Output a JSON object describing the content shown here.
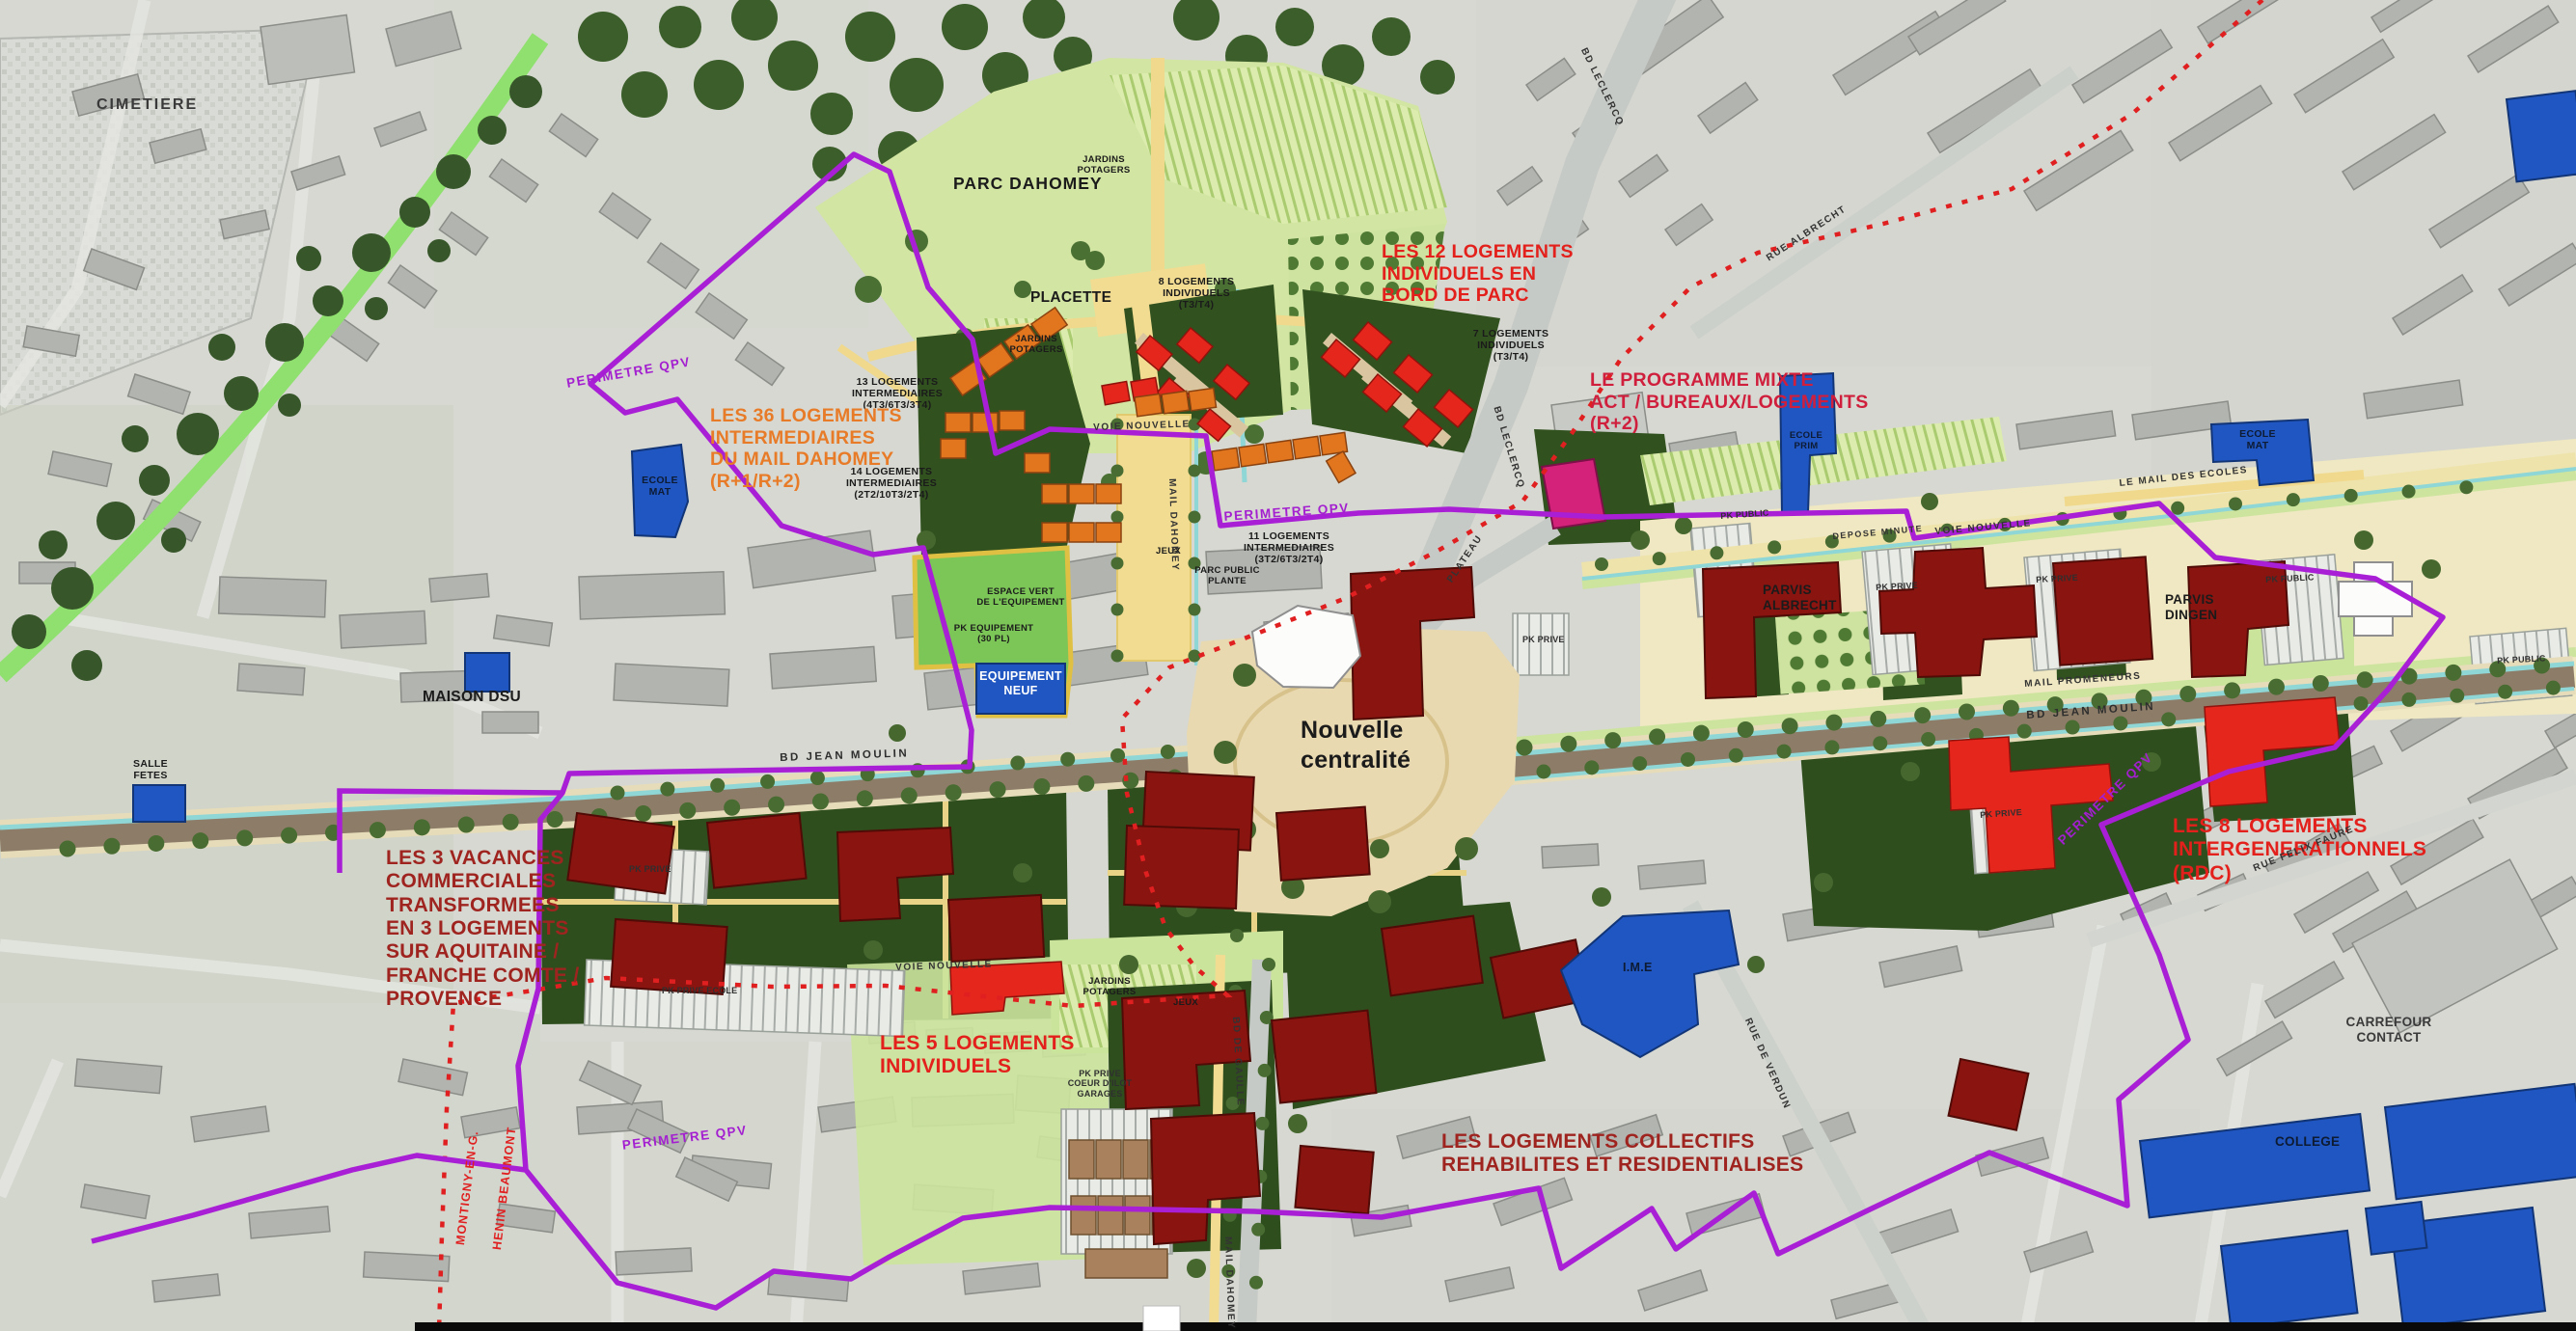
{
  "annotations": {
    "les12": "LES 12 LOGEMENTS\nINDIVIDUELS EN\nBORD DE PARC",
    "mixte": "LE PROGRAMME MIXTE\nACT / BUREAUX/LOGEMENTS\n(R+2)",
    "les36": "LES 36 LOGEMENTS\nINTERMEDIAIRES\nDU MAIL DAHOMEY\n(R+1/R+2)",
    "vacances": "LES 3 VACANCES\nCOMMERCIALES\nTRANSFORMEES\nEN 3 LOGEMENTS\nSUR AQUITAINE /\nFRANCHE COMTE /\nPROVENCE",
    "les5": "LES 5 LOGEMENTS\nINDIVIDUELS",
    "collectifs": "LES LOGEMENTS COLLECTIFS\nREHABILITES ET RESIDENTIALISES",
    "les8": "LES 8 LOGEMENTS\nINTERGENERATIONNELS\n(RDC)"
  },
  "places": {
    "parc": "PARC DAHOMEY",
    "placette": "PLACETTE",
    "centralite": "Nouvelle\ncentralité",
    "maison_dsu": "MAISON DSU",
    "salle_fetes": "SALLE\nFETES",
    "cimetiere": "CIMETIERE",
    "ecole_mat": "ECOLE\nMAT",
    "ecole_prim": "ECOLE\nPRIM",
    "equipement": "EQUIPEMENT\nNEUF",
    "ime": "I.M.E",
    "college": "COLLEGE",
    "carrefour": "CARREFOUR\nCONTACT",
    "parvis_albrecht": "PARVIS\nALBRECHT",
    "parvis_dingen": "PARVIS\nDINGEN"
  },
  "programs": {
    "l8": "8 LOGEMENTS\nINDIVIDUELS\n(T3/T4)",
    "l7": "7 LOGEMENTS\nINDIVIDUELS\n(T3/T4)",
    "l13": "13 LOGEMENTS\nINTERMEDIAIRES\n(4T3/6T3/3T4)",
    "l14": "14 LOGEMENTS\nINTERMEDIAIRES\n(2T2/10T3/2T4)",
    "l11": "11 LOGEMENTS\nINTERMEDIAIRES\n(3T2/6T3/2T4)",
    "espace_vert": "ESPACE VERT\nDE L'EQUIPEMENT",
    "pk_equipement": "PK EQUIPEMENT\n(30 PL)",
    "parc_plante": "PARC PUBLIC\nPLANTE",
    "jardins": "JARDINS\nPOTAGERS",
    "jeux": "JEUX"
  },
  "roads": {
    "jean_moulin": "BD JEAN MOULIN",
    "leclercq": "BD LECLERCQ",
    "albrecht": "RUE ALBRECHT",
    "voie_nouvelle": "VOIE NOUVELLE",
    "depose": "DEPOSE MINUTE",
    "plateau": "PLATEAU",
    "verdun": "RUE DE VERDUN",
    "gaulle": "BD DE GAULLE",
    "mail_dahomey": "MAIL DAHOMEY",
    "promeneurs": "MAIL PROMENEURS",
    "mail_ecoles": "LE MAIL DES ECOLES",
    "felix_faure": "RUE FELIX FAURE"
  },
  "boundaries": {
    "qpv": "PERIMETRE QPV",
    "montigny": "MONTIGNY-EN-G.",
    "henin": "HENIN BEAUMONT"
  },
  "parking": {
    "pk_public": "PK PUBLIC",
    "pk_prive": "PK PRIVE",
    "pk_ecole": "PK PRIVE ECOLE",
    "coeur": "PK PRIVE\nCOEUR D'ILOT\nGARAGES"
  },
  "colors": {
    "qpv_purple": "#a81fd6",
    "commune_red": "#e02020",
    "annotation_red": "#e3201b",
    "annotation_darkred": "#9f2420",
    "annotation_orange": "#e87b28",
    "annotation_crimson": "#d01f3c",
    "equipement_blue": "#2056c2",
    "collectif_darkred": "#8a1410",
    "new_red": "#e5261c",
    "intermediaire_orange": "#e2761f",
    "mixte_magenta": "#d4217a",
    "park_green": "#d2e5a2",
    "dark_green": "#31511f"
  }
}
